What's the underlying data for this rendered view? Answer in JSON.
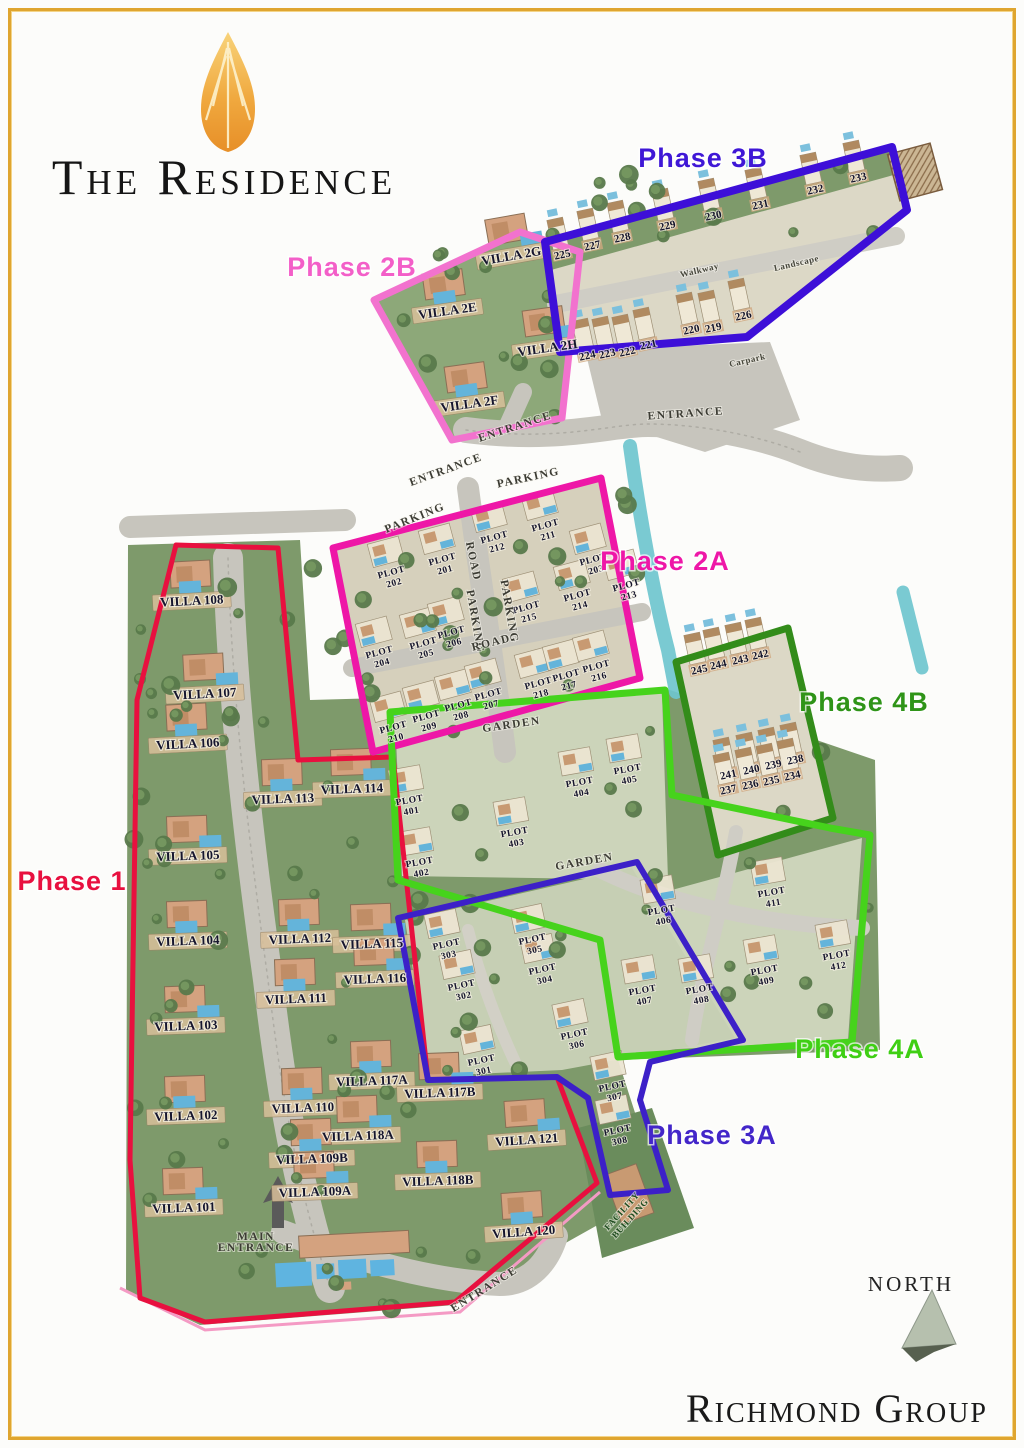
{
  "branding": {
    "title": "The Residence",
    "developer": "Richmond Group",
    "north_label": "NORTH",
    "logo_icon": "flame-teardrop-icon",
    "logo_color": "#ef9d2e"
  },
  "colors": {
    "phase1": "#e8103f",
    "phase2a": "#ee17a7",
    "phase2b": "#f272ce",
    "phase3a": "#3c20c8",
    "phase3b": "#3d0fd8",
    "phase4a": "#46d31c",
    "phase4b": "#338c1a",
    "land": "#7e9a6b",
    "road": "#c7c5bd",
    "canal": "#6fc5ce",
    "pool": "#64b4da",
    "building": "#d4a27f"
  },
  "phase_labels": [
    {
      "text": "Phase 1",
      "x": 72,
      "y": 890,
      "color": "#e8103f"
    },
    {
      "text": "Phase 2A",
      "x": 665,
      "y": 570,
      "color": "#ee17a7"
    },
    {
      "text": "Phase 2B",
      "x": 352,
      "y": 276,
      "color": "#f35fc8"
    },
    {
      "text": "Phase 3A",
      "x": 712,
      "y": 1144,
      "color": "#4326c9"
    },
    {
      "text": "Phase 3B",
      "x": 703,
      "y": 167,
      "color": "#3f17d6"
    },
    {
      "text": "Phase 4A",
      "x": 860,
      "y": 1058,
      "color": "#3fcf14"
    },
    {
      "text": "Phase 4B",
      "x": 864,
      "y": 711,
      "color": "#2f9418"
    }
  ],
  "villa_labels": [
    {
      "text": "VILLA 108",
      "x": 192,
      "y": 605,
      "rot": -3
    },
    {
      "text": "VILLA 107",
      "x": 205,
      "y": 698,
      "rot": -3
    },
    {
      "text": "VILLA 106",
      "x": 188,
      "y": 748,
      "rot": -3
    },
    {
      "text": "VILLA 105",
      "x": 188,
      "y": 860,
      "rot": -2
    },
    {
      "text": "VILLA 104",
      "x": 188,
      "y": 945,
      "rot": -2
    },
    {
      "text": "VILLA 103",
      "x": 186,
      "y": 1030,
      "rot": -2
    },
    {
      "text": "VILLA 102",
      "x": 186,
      "y": 1120,
      "rot": -2
    },
    {
      "text": "VILLA 101",
      "x": 184,
      "y": 1212,
      "rot": -2
    },
    {
      "text": "VILLA 113",
      "x": 283,
      "y": 803,
      "rot": -2
    },
    {
      "text": "VILLA 114",
      "x": 352,
      "y": 793,
      "rot": -2
    },
    {
      "text": "VILLA 112",
      "x": 300,
      "y": 943,
      "rot": -2
    },
    {
      "text": "VILLA 115",
      "x": 372,
      "y": 948,
      "rot": -2
    },
    {
      "text": "VILLA 111",
      "x": 296,
      "y": 1003,
      "rot": -2
    },
    {
      "text": "VILLA 116",
      "x": 375,
      "y": 983,
      "rot": -2
    },
    {
      "text": "VILLA 117A",
      "x": 372,
      "y": 1085,
      "rot": -2
    },
    {
      "text": "VILLA 117B",
      "x": 440,
      "y": 1097,
      "rot": -2
    },
    {
      "text": "VILLA 110",
      "x": 303,
      "y": 1112,
      "rot": -2
    },
    {
      "text": "VILLA 118A",
      "x": 358,
      "y": 1140,
      "rot": -2
    },
    {
      "text": "VILLA 109B",
      "x": 312,
      "y": 1163,
      "rot": -2
    },
    {
      "text": "VILLA 109A",
      "x": 315,
      "y": 1196,
      "rot": -2
    },
    {
      "text": "VILLA 118B",
      "x": 438,
      "y": 1185,
      "rot": -2
    },
    {
      "text": "VILLA 121",
      "x": 527,
      "y": 1144,
      "rot": -4
    },
    {
      "text": "VILLA 120",
      "x": 524,
      "y": 1236,
      "rot": -4
    },
    {
      "text": "VILLA 2G",
      "x": 512,
      "y": 260,
      "rot": -10
    },
    {
      "text": "VILLA 2E",
      "x": 448,
      "y": 315,
      "rot": -8
    },
    {
      "text": "VILLA 2H",
      "x": 548,
      "y": 352,
      "rot": -8
    },
    {
      "text": "VILLA 2F",
      "x": 470,
      "y": 408,
      "rot": -8
    }
  ],
  "plot_labels": [
    {
      "text": "PLOT 202",
      "x": 392,
      "y": 575,
      "rot": -15
    },
    {
      "text": "PLOT 201",
      "x": 443,
      "y": 562,
      "rot": -15
    },
    {
      "text": "PLOT 212",
      "x": 495,
      "y": 540,
      "rot": -15
    },
    {
      "text": "PLOT 211",
      "x": 546,
      "y": 528,
      "rot": -15
    },
    {
      "text": "PLOT 203",
      "x": 594,
      "y": 562,
      "rot": -15
    },
    {
      "text": "PLOT 213",
      "x": 627,
      "y": 588,
      "rot": -15
    },
    {
      "text": "PLOT 214",
      "x": 578,
      "y": 598,
      "rot": -15
    },
    {
      "text": "PLOT 215",
      "x": 527,
      "y": 610,
      "rot": -15
    },
    {
      "text": "PLOT 204",
      "x": 380,
      "y": 655,
      "rot": -15
    },
    {
      "text": "PLOT 205",
      "x": 424,
      "y": 646,
      "rot": -15
    },
    {
      "text": "PLOT 206",
      "x": 452,
      "y": 635,
      "rot": -15
    },
    {
      "text": "PLOT 210",
      "x": 394,
      "y": 730,
      "rot": -15
    },
    {
      "text": "PLOT 209",
      "x": 427,
      "y": 719,
      "rot": -15
    },
    {
      "text": "PLOT 208",
      "x": 459,
      "y": 708,
      "rot": -15
    },
    {
      "text": "PLOT 207",
      "x": 489,
      "y": 697,
      "rot": -15
    },
    {
      "text": "PLOT 218",
      "x": 539,
      "y": 686,
      "rot": -15
    },
    {
      "text": "PLOT 217",
      "x": 567,
      "y": 678,
      "rot": -15
    },
    {
      "text": "PLOT 216",
      "x": 597,
      "y": 669,
      "rot": -15
    },
    {
      "text": "PLOT 303",
      "x": 447,
      "y": 947,
      "rot": -12
    },
    {
      "text": "PLOT 302",
      "x": 462,
      "y": 988,
      "rot": -12
    },
    {
      "text": "PLOT 305",
      "x": 533,
      "y": 942,
      "rot": -12
    },
    {
      "text": "PLOT 304",
      "x": 543,
      "y": 972,
      "rot": -12
    },
    {
      "text": "PLOT 306",
      "x": 575,
      "y": 1037,
      "rot": -12
    },
    {
      "text": "PLOT 301",
      "x": 482,
      "y": 1063,
      "rot": -12
    },
    {
      "text": "PLOT 307",
      "x": 613,
      "y": 1089,
      "rot": -12
    },
    {
      "text": "PLOT 308",
      "x": 618,
      "y": 1133,
      "rot": -12
    },
    {
      "text": "PLOT 401",
      "x": 410,
      "y": 803,
      "rot": -10
    },
    {
      "text": "PLOT 402",
      "x": 420,
      "y": 865,
      "rot": -10
    },
    {
      "text": "PLOT 403",
      "x": 515,
      "y": 835,
      "rot": -10
    },
    {
      "text": "PLOT 404",
      "x": 580,
      "y": 785,
      "rot": -10
    },
    {
      "text": "PLOT 405",
      "x": 628,
      "y": 772,
      "rot": -10
    },
    {
      "text": "PLOT 406",
      "x": 662,
      "y": 913,
      "rot": -10
    },
    {
      "text": "PLOT 411",
      "x": 772,
      "y": 895,
      "rot": -10
    },
    {
      "text": "PLOT 407",
      "x": 643,
      "y": 993,
      "rot": -10
    },
    {
      "text": "PLOT 408",
      "x": 700,
      "y": 992,
      "rot": -10
    },
    {
      "text": "PLOT 409",
      "x": 765,
      "y": 973,
      "rot": -10
    },
    {
      "text": "PLOT 412",
      "x": 837,
      "y": 958,
      "rot": -10
    }
  ],
  "unit_labels": [
    {
      "text": "225",
      "x": 563,
      "y": 258,
      "rot": -12
    },
    {
      "text": "227",
      "x": 593,
      "y": 249,
      "rot": -12
    },
    {
      "text": "228",
      "x": 623,
      "y": 241,
      "rot": -12
    },
    {
      "text": "229",
      "x": 668,
      "y": 229,
      "rot": -12
    },
    {
      "text": "230",
      "x": 714,
      "y": 219,
      "rot": -12
    },
    {
      "text": "231",
      "x": 761,
      "y": 208,
      "rot": -12
    },
    {
      "text": "232",
      "x": 816,
      "y": 193,
      "rot": -12
    },
    {
      "text": "233",
      "x": 859,
      "y": 181,
      "rot": -12
    },
    {
      "text": "224",
      "x": 588,
      "y": 359,
      "rot": -12
    },
    {
      "text": "223",
      "x": 608,
      "y": 357,
      "rot": -12
    },
    {
      "text": "222",
      "x": 628,
      "y": 355,
      "rot": -12
    },
    {
      "text": "221",
      "x": 649,
      "y": 348,
      "rot": -12
    },
    {
      "text": "220",
      "x": 692,
      "y": 333,
      "rot": -12
    },
    {
      "text": "219",
      "x": 714,
      "y": 331,
      "rot": -12
    },
    {
      "text": "226",
      "x": 744,
      "y": 319,
      "rot": -12
    },
    {
      "text": "245",
      "x": 700,
      "y": 673,
      "rot": -12
    },
    {
      "text": "244",
      "x": 719,
      "y": 668,
      "rot": -12
    },
    {
      "text": "243",
      "x": 741,
      "y": 663,
      "rot": -12
    },
    {
      "text": "242",
      "x": 761,
      "y": 658,
      "rot": -12
    },
    {
      "text": "241",
      "x": 729,
      "y": 778,
      "rot": -12
    },
    {
      "text": "240",
      "x": 752,
      "y": 773,
      "rot": -12
    },
    {
      "text": "239",
      "x": 774,
      "y": 768,
      "rot": -12
    },
    {
      "text": "238",
      "x": 796,
      "y": 763,
      "rot": -12
    },
    {
      "text": "237",
      "x": 729,
      "y": 793,
      "rot": -12
    },
    {
      "text": "236",
      "x": 751,
      "y": 788,
      "rot": -12
    },
    {
      "text": "235",
      "x": 772,
      "y": 784,
      "rot": -12
    },
    {
      "text": "234",
      "x": 793,
      "y": 779,
      "rot": -12
    }
  ],
  "road_labels": [
    {
      "text": "ENTRANCE",
      "x": 516,
      "y": 430,
      "rot": -18
    },
    {
      "text": "ENTRANCE",
      "x": 686,
      "y": 417,
      "rot": -4
    },
    {
      "text": "ENTRANCE",
      "x": 447,
      "y": 473,
      "rot": -20
    },
    {
      "text": "PARKING",
      "x": 529,
      "y": 481,
      "rot": -12
    },
    {
      "text": "PARKING",
      "x": 416,
      "y": 521,
      "rot": -22
    },
    {
      "text": "ROAD",
      "x": 470,
      "y": 562,
      "rot": 78
    },
    {
      "text": "PARKING",
      "x": 472,
      "y": 622,
      "rot": 80
    },
    {
      "text": "PARKING",
      "x": 506,
      "y": 612,
      "rot": 80
    },
    {
      "text": "ROAD",
      "x": 492,
      "y": 646,
      "rot": -14
    },
    {
      "text": "GARDEN",
      "x": 512,
      "y": 728,
      "rot": -8
    },
    {
      "text": "GARDEN",
      "x": 585,
      "y": 865,
      "rot": -10
    },
    {
      "text": "Walkway",
      "x": 700,
      "y": 273,
      "rot": -13,
      "style": "small"
    },
    {
      "text": "Landscape",
      "x": 797,
      "y": 266,
      "rot": -13,
      "style": "small"
    },
    {
      "text": "Carpark",
      "x": 748,
      "y": 363,
      "rot": -13,
      "style": "small"
    },
    {
      "text": "ENTRANCE",
      "x": 486,
      "y": 1292,
      "rot": -32
    },
    {
      "text": "MAIN\nENTRANCE",
      "x": 256,
      "y": 1240,
      "rot": 0
    },
    {
      "text": "FACILITY\nBUILDING",
      "x": 624,
      "y": 1213,
      "rot": -48,
      "style": "facility"
    }
  ]
}
